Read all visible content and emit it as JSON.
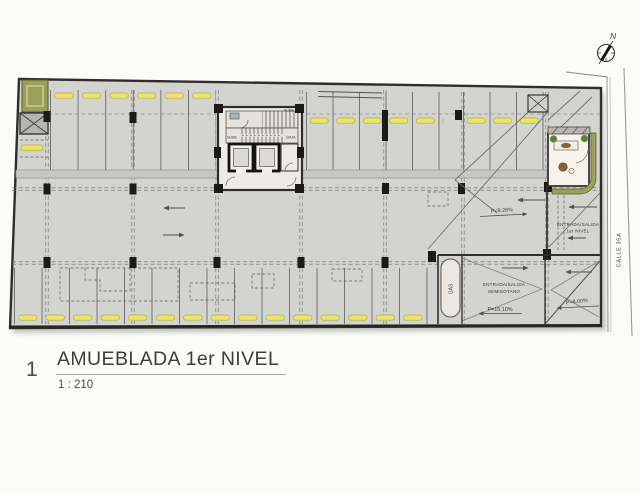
{
  "plan": {
    "core": {
      "sube_top": "SUBE",
      "sube": "SUBE",
      "baja": "BAJA"
    },
    "gas_label": "GAS",
    "entrance_level1": {
      "line1": "ENTRADA/SALIDA",
      "line2": "1er NIVEL",
      "slope": "P=9.26%"
    },
    "entrance_basement": {
      "line1": "ENTRADA/SALIDA",
      "line2": "SEMISOTANO",
      "slope": "P=15.10%"
    },
    "street_ramp_slope": "P=8.00%",
    "street_name": "CALLE 35A",
    "north_label": "N"
  },
  "title_block": {
    "number": "1",
    "title": "AMUEBLADA 1er NIVEL",
    "scale": "1 : 210"
  },
  "colors": {
    "page_bg": "#fbfbfa",
    "plan_fill": "#d3d3d0",
    "wall_dark": "#2f2e2a",
    "stop_yellow": "#e9e567",
    "stop_border": "#b4ad42",
    "planter_olive": "#9aa156",
    "core_fill": "#edebe4",
    "office_fill": "#f5f3ec",
    "band_gray": "#c7c7c3",
    "accent_blue": "#9db6c8",
    "wood_brown": "#8a6238",
    "plant_green": "#5d7a3f"
  }
}
